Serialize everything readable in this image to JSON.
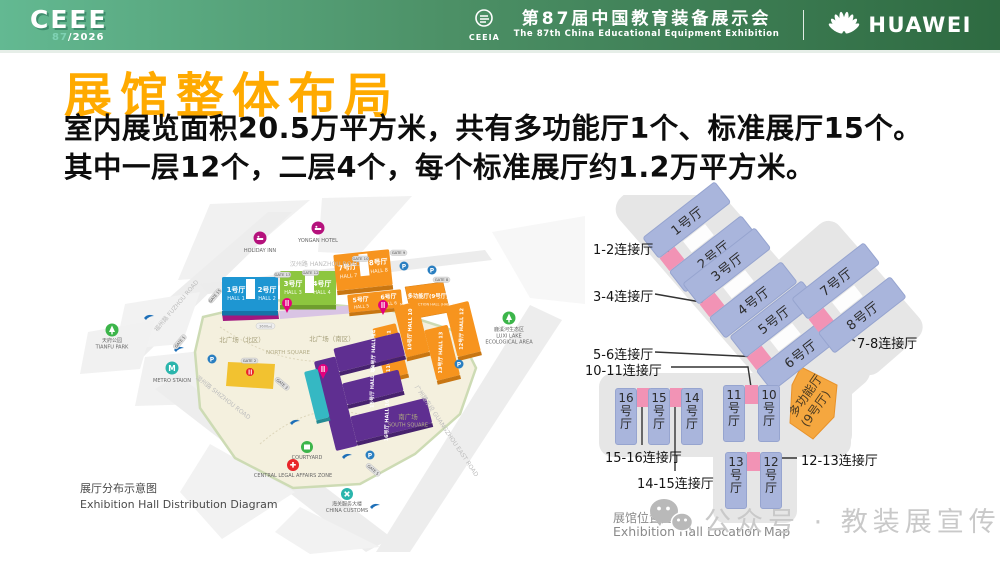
{
  "header": {
    "logo": {
      "main": "CEEE",
      "sub_num": "87",
      "sub_year": "/2026"
    },
    "ceeia_label": "CEEIA",
    "event_cn": "第87届中国教育装备展示会",
    "event_en": "The 87th China Educational Equipment Exhibition",
    "huawei_label": "HUAWEI"
  },
  "title": "展馆整体布局",
  "intro": {
    "line1": "室内展览面积20.5万平方米，共有多功能厅1个、标准展厅15个。",
    "line2": "其中一层12个，二层4个，每个标准展厅约1.2万平方米。"
  },
  "left_map": {
    "caption_cn": "展厅分布示意图",
    "caption_en": "Exhibition Hall Distribution Diagram",
    "roads": {
      "hanzhou": "汉州路 HANZHOU ROAD",
      "fuzhou": "福州路 FUZHOU ROAD",
      "shizhou": "湿州路 SHIZHOU ROAD",
      "guangzhou": "广州路东段 GUANGZHOU EAST ROAD"
    },
    "squares": {
      "north_cn": "北广场（北区）",
      "north_en": "NORTH SQUARE",
      "north2_cn": "北广场（南区）",
      "south_cn": "南广场",
      "south_en": "SOUTH SQUARE"
    },
    "halls": {
      "h1_cn": "1号厅",
      "h1_en": "HALL 1",
      "h2_cn": "2号厅",
      "h2_en": "HALL 2",
      "h3_cn": "3号厅",
      "h3_en": "HALL 3",
      "h4_cn": "4号厅",
      "h4_en": "HALL 4",
      "h5_cn": "5号厅",
      "h5_en": "HALL 5",
      "h6_cn": "6号厅",
      "h6_en": "HALL 6",
      "h7_cn": "7号厅",
      "h7_en": "HALL 7",
      "h8_cn": "8号厅",
      "h8_en": "HALL 8",
      "mf_cn": "多功能厅(9号厅)",
      "mf_en": "MULTIFUNCTION HALL (HALL 9)",
      "h10": "10号厅 HALL 10",
      "h11": "11号厅 HALL 11",
      "h12": "12号厅 HALL 12",
      "h13": "13号厅 HALL 13",
      "h14": "14号厅 HALL 14",
      "h15": "15号厅 HALL 15",
      "h16": "16号厅 HALL 16"
    },
    "pois": {
      "holiday": "HOLIDAY INN",
      "yongan": "YONGAN HOTEL",
      "tianfu_cn": "天府公园",
      "tianfu_en": "TIANFU PARK",
      "metro": "METRO STAION",
      "luxi_cn": "鹿溪河生态区",
      "luxi_en1": "LUXI LAKE",
      "luxi_en2": "ECOLOGICAL AREA",
      "courtyard": "COURTYARD",
      "legal": "CENTRAL LEGAL AFFAIRS ZONE",
      "customs_cn": "海关服务大楼",
      "customs_en": "CHINA CUSTOMS"
    },
    "gates": {
      "g1": "GATE 1",
      "g2": "GATE 2",
      "g3": "GATE 3",
      "g5": "GATE 5",
      "g8": "GATE 8",
      "g9": "GATE 9",
      "g10": "GATE 10",
      "g12": "GATE 12",
      "g13": "GATE 13",
      "g15": "GATE 15"
    },
    "area_badge": "3600㎡"
  },
  "right_map": {
    "halls": {
      "h1": "1号厅",
      "h2": "2号厅",
      "h3": "3号厅",
      "h4": "4号厅",
      "h5": "5号厅",
      "h6": "6号厅",
      "h7": "7号厅",
      "h8": "8号厅",
      "h10": "10号厅",
      "h11": "11号厅",
      "h12": "12号厅",
      "h13": "13号厅",
      "h14": "14号厅",
      "h15": "15号厅",
      "h16": "16号厅",
      "mf1": "多功能厅",
      "mf2": "(9号厅)"
    },
    "connectors": {
      "c12": "1-2连接厅",
      "c34": "3-4连接厅",
      "c56": "5-6连接厅",
      "c78": "7-8连接厅",
      "c1011": "10-11连接厅",
      "c1213": "12-13连接厅",
      "c1415": "14-15连接厅",
      "c1516": "15-16连接厅"
    },
    "caption_cn": "展馆位置图",
    "caption_en": "Exhibition Hall Location Map"
  },
  "watermark": {
    "text": "公众号 · 教装展宣传"
  },
  "colors": {
    "title_orange": "#FFAA00",
    "header_green_left": "#63b992",
    "header_green_right": "#2e6a41",
    "hall_blue": "#1e96d2",
    "hall_green": "#8dc63f",
    "hall_orange": "#f7941e",
    "hall_purple": "#5f2f91",
    "corridor_magenta": "#a1187f",
    "diagram_hall_fill": "#a9b5dc",
    "diagram_connector_pink": "#f293b5",
    "diagram_mf_orange": "#f5a73f"
  }
}
